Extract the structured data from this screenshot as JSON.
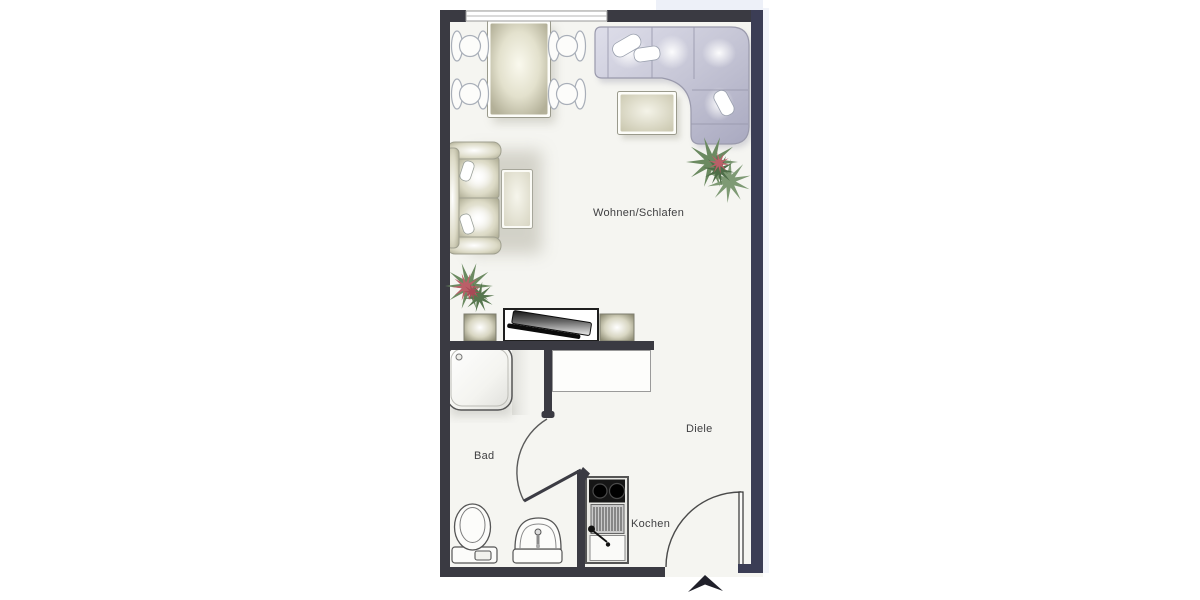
{
  "plan": {
    "title_none": "",
    "rooms": [
      {
        "name": "living-sleeping-room",
        "label": "Wohnen/Schlafen"
      },
      {
        "name": "bathroom",
        "label": "Bad"
      },
      {
        "name": "hallway",
        "label": "Diele"
      },
      {
        "name": "kitchen",
        "label": "Kochen"
      }
    ],
    "furniture": [
      "dining-table",
      "dining-chair",
      "corner-sofa",
      "sofa-pillow",
      "coffee-table",
      "loveseat",
      "side-table",
      "plant",
      "tv-lowboard",
      "speaker",
      "tv",
      "wardrobe",
      "shower",
      "toilet",
      "washbasin",
      "kitchenette-stove-sink",
      "window",
      "bathroom-door",
      "entrance-door",
      "entrance-arrow"
    ]
  },
  "colors": {
    "wall": "#3a3a42",
    "wall_accent": "#3b3d55",
    "floor": "#f5f5f1",
    "line": "#555555",
    "text": "#3f3f41",
    "furniture_beige": "#b5b29a",
    "furniture_lavender": "#c6c6d6",
    "plant_green": "#6b8a61",
    "plant_red": "#bb5f68",
    "scan_band": "#e9ecf6"
  }
}
